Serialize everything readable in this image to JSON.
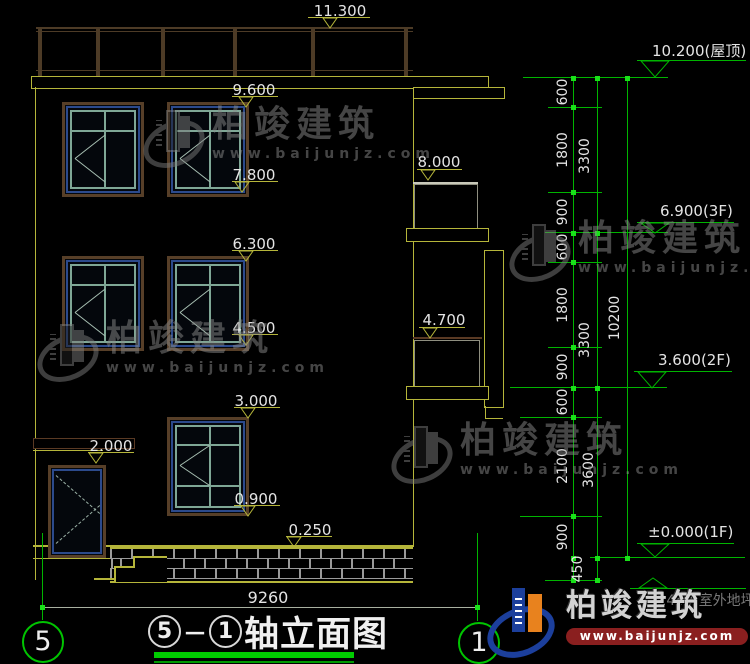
{
  "annotations": {
    "left": {
      "m11300": "11.300",
      "m9600": "9.600",
      "m7800": "7.800",
      "m8000": "8.000",
      "m6300": "6.300",
      "m4500": "4.500",
      "m4700": "4.700",
      "m3000": "3.000",
      "m2000": "2.000",
      "m0900": "0.900",
      "m0250": "0.250"
    },
    "right": {
      "roof": "10.200(屋顶)",
      "f3": "6.900(3F)",
      "f2": "3.600(2F)",
      "f1": "±0.000(1F)",
      "ground": "-0.450(室外地坪)"
    },
    "dims": {
      "chain_inner": [
        "600",
        "1800",
        "900",
        "600",
        "1800",
        "900",
        "600",
        "2100",
        "900",
        "450"
      ],
      "chain_mid": [
        "3300",
        "3300",
        "3600"
      ],
      "chain_outer": [
        "10200"
      ],
      "width": "9260"
    }
  },
  "grid": {
    "left_bubble": "5",
    "right_bubble": "1"
  },
  "title_block": {
    "prefix": "5",
    "dash": "－",
    "suffix": "1",
    "name": "轴立面图"
  },
  "watermark": {
    "brand": "柏竣建筑",
    "site": "www.baijunjz.com"
  },
  "logo": {
    "brand": "柏竣建筑",
    "site": "www.baijunjz.com"
  },
  "colors": {
    "outline_yellow": "#b5b53a",
    "dim_green": "#00b400",
    "frame_brown": "#573f28",
    "sash_teal": "#7fa796",
    "accent_blue": "#2c4a8c",
    "logo_blue": "#1c3f9c",
    "logo_orange": "#e8821e",
    "logo_red_bar": "#8a1f1f"
  }
}
